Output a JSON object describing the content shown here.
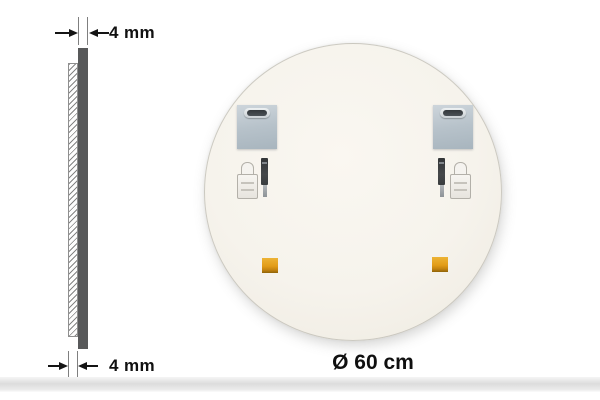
{
  "annotations": {
    "thickness_top": "4 mm",
    "thickness_bottom": "4 mm",
    "diameter": "Ø 60 cm"
  },
  "colors": {
    "background": "#ffffff",
    "mirror_face": "#f6f3ec",
    "glass_edge_bar": "#58595a",
    "dimension_line": "#141414",
    "extension_line": "#7f7f7f",
    "mounting_plate": "#b7c2ca",
    "plate_slot": "#33383b",
    "adhesive_pad": "#e29c17",
    "adhesive_pad_shadow": "#8f6408",
    "hardware_pen": "#45484a",
    "hardware_anchor": "#f5f3ef",
    "floor_band": "#dcdcdc"
  }
}
